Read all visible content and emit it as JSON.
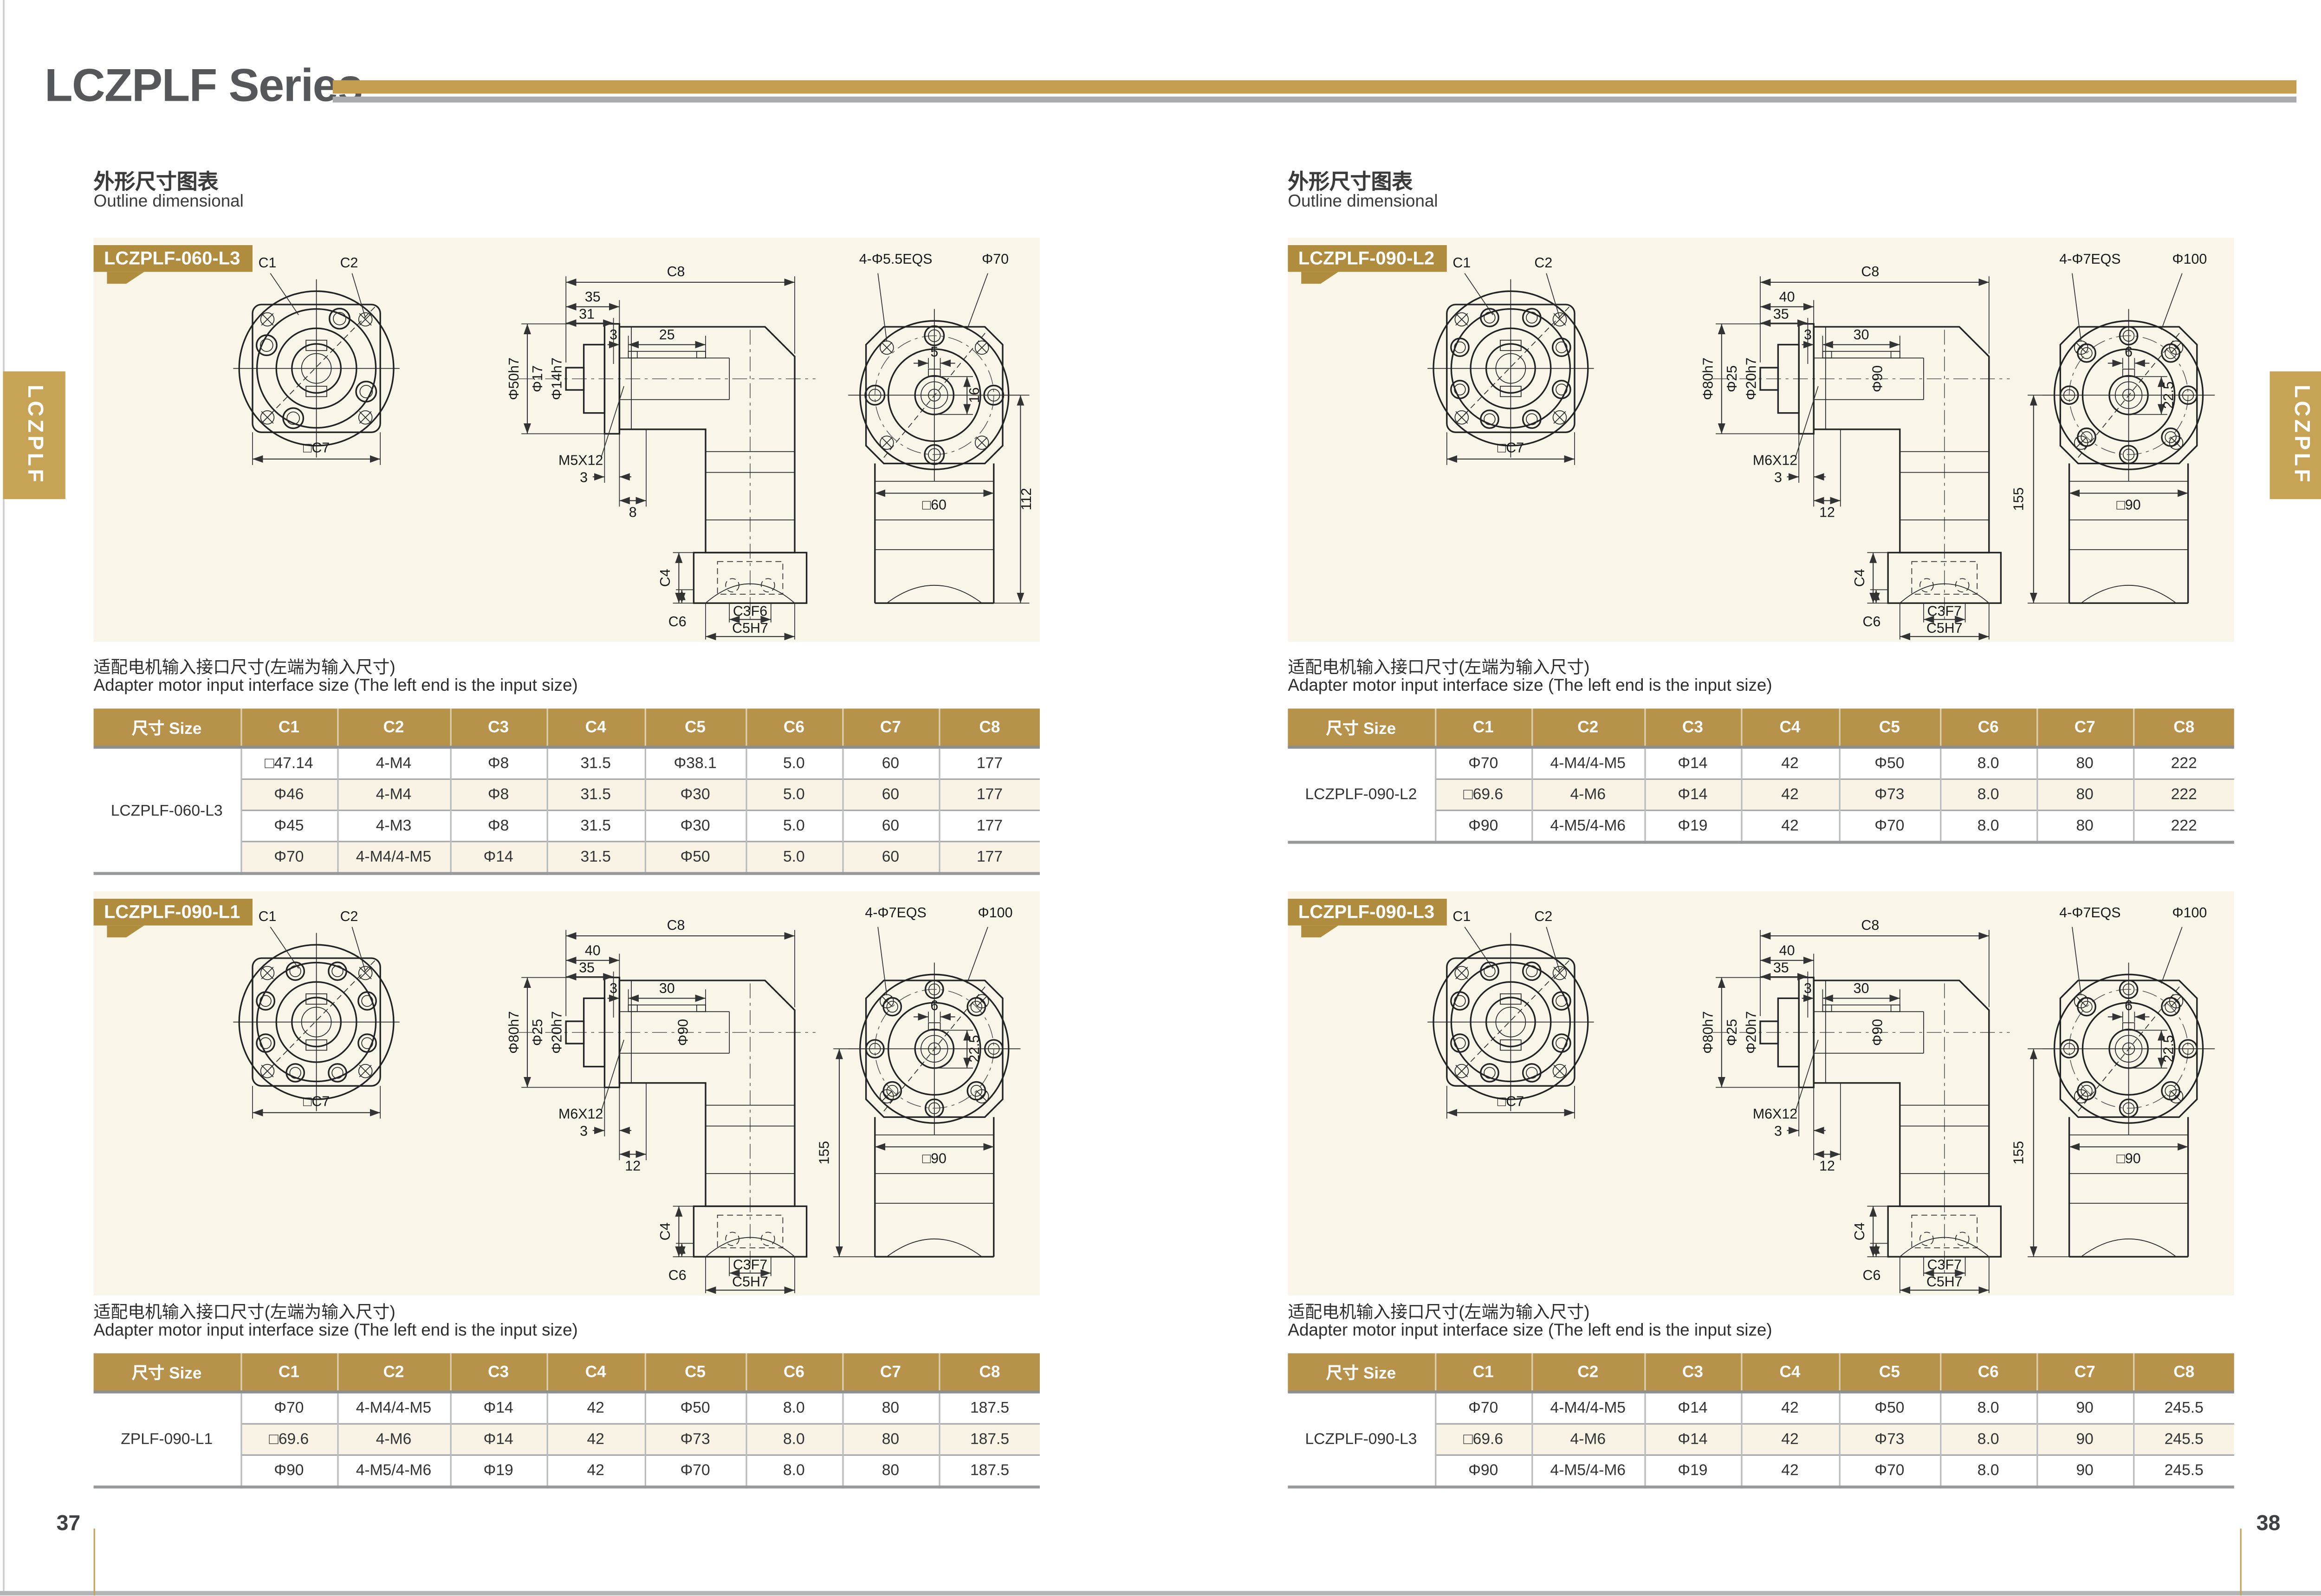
{
  "page": {
    "title": "LCZPLF Series",
    "side_tab": "LCZPLF",
    "page_no_left": "37",
    "page_no_right": "38"
  },
  "colors": {
    "accent_gold": "#c49d4f",
    "badge_gold": "#af8c3e",
    "table_header_gold": "#b6924a",
    "panel_cream": "#f9f5e8",
    "title_gray": "#56575b"
  },
  "section_heading": {
    "zh": "外形尺寸图表",
    "en": "Outline dimensional"
  },
  "note": {
    "zh": "适配电机输入接口尺寸(左端为输入尺寸)",
    "en": "Adapter motor input interface size (The left end is the input size)"
  },
  "columns": [
    "尺寸 Size",
    "C1",
    "C2",
    "C3",
    "C4",
    "C5",
    "C6",
    "C7",
    "C8"
  ],
  "panels": [
    {
      "badge": "LCZPLF-060-L3",
      "row_label": "LCZPLF-060-L3",
      "labels": {
        "c1": "C1",
        "c2": "C2",
        "c7": "□C7",
        "c8": "C8",
        "dimA": "35",
        "dimB": "31",
        "dimC": "3",
        "dimD": "25",
        "shaft1": "Φ50h7",
        "shaft2": "Φ17",
        "shaft3": "Φ14h7",
        "thread": "M5X12",
        "botA": "3",
        "botB": "8",
        "bolts": "4-Φ5.5EQS",
        "flange": "Φ70",
        "key": "5",
        "depth": "16",
        "square": "□60",
        "height": "112",
        "c4": "C4",
        "c6": "C6",
        "c3": "C3F6",
        "c5": "C5H7"
      },
      "rows": [
        [
          "□47.14",
          "4-M4",
          "Φ8",
          "31.5",
          "Φ38.1",
          "5.0",
          "60",
          "177"
        ],
        [
          "Φ46",
          "4-M4",
          "Φ8",
          "31.5",
          "Φ30",
          "5.0",
          "60",
          "177"
        ],
        [
          "Φ45",
          "4-M3",
          "Φ8",
          "31.5",
          "Φ30",
          "5.0",
          "60",
          "177"
        ],
        [
          "Φ70",
          "4-M4/4-M5",
          "Φ14",
          "31.5",
          "Φ50",
          "5.0",
          "60",
          "177"
        ]
      ]
    },
    {
      "badge": "LCZPLF-090-L2",
      "row_label": "LCZPLF-090-L2",
      "labels": {
        "c1": "C1",
        "c2": "C2",
        "c7": "□C7",
        "c8": "C8",
        "dimA": "40",
        "dimB": "35",
        "dimC": "3",
        "dimD": "30",
        "shaft1": "Φ80h7",
        "shaft2": "Φ25",
        "shaft3": "Φ20h7",
        "thread": "M6X12",
        "botA": "3",
        "botB": "12",
        "body": "Φ90",
        "bolts": "4-Φ7EQS",
        "flange": "Φ100",
        "key": "6",
        "depth": "22.5",
        "square": "□90",
        "height": "155",
        "c4": "C4",
        "c6": "C6",
        "c3": "C3F7",
        "c5": "C5H7"
      },
      "rows": [
        [
          "Φ70",
          "4-M4/4-M5",
          "Φ14",
          "42",
          "Φ50",
          "8.0",
          "80",
          "222"
        ],
        [
          "□69.6",
          "4-M6",
          "Φ14",
          "42",
          "Φ73",
          "8.0",
          "80",
          "222"
        ],
        [
          "Φ90",
          "4-M5/4-M6",
          "Φ19",
          "42",
          "Φ70",
          "8.0",
          "80",
          "222"
        ]
      ]
    },
    {
      "badge": "LCZPLF-090-L1",
      "row_label": "ZPLF-090-L1",
      "labels": {
        "c1": "C1",
        "c2": "C2",
        "c7": "□C7",
        "c8": "C8",
        "dimA": "40",
        "dimB": "35",
        "dimC": "3",
        "dimD": "30",
        "shaft1": "Φ80h7",
        "shaft2": "Φ25",
        "shaft3": "Φ20h7",
        "thread": "M6X12",
        "botA": "3",
        "botB": "12",
        "body": "Φ90",
        "bolts": "4-Φ7EQS",
        "flange": "Φ100",
        "key": "6",
        "depth": "22.5",
        "square": "□90",
        "height": "155",
        "c4": "C4",
        "c6": "C6",
        "c3": "C3F7",
        "c5": "C5H7"
      },
      "rows": [
        [
          "Φ70",
          "4-M4/4-M5",
          "Φ14",
          "42",
          "Φ50",
          "8.0",
          "80",
          "187.5"
        ],
        [
          "□69.6",
          "4-M6",
          "Φ14",
          "42",
          "Φ73",
          "8.0",
          "80",
          "187.5"
        ],
        [
          "Φ90",
          "4-M5/4-M6",
          "Φ19",
          "42",
          "Φ70",
          "8.0",
          "80",
          "187.5"
        ]
      ]
    },
    {
      "badge": "LCZPLF-090-L3",
      "row_label": "LCZPLF-090-L3",
      "labels": {
        "c1": "C1",
        "c2": "C2",
        "c7": "□C7",
        "c8": "C8",
        "dimA": "40",
        "dimB": "35",
        "dimC": "3",
        "dimD": "30",
        "shaft1": "Φ80h7",
        "shaft2": "Φ25",
        "shaft3": "Φ20h7",
        "thread": "M6X12",
        "botA": "3",
        "botB": "12",
        "body": "Φ90",
        "bolts": "4-Φ7EQS",
        "flange": "Φ100",
        "key": "6",
        "depth": "22.5",
        "square": "□90",
        "height": "155",
        "c4": "C4",
        "c6": "C6",
        "c3": "C3F7",
        "c5": "C5H7"
      },
      "rows": [
        [
          "Φ70",
          "4-M4/4-M5",
          "Φ14",
          "42",
          "Φ50",
          "8.0",
          "90",
          "245.5"
        ],
        [
          "□69.6",
          "4-M6",
          "Φ14",
          "42",
          "Φ73",
          "8.0",
          "90",
          "245.5"
        ],
        [
          "Φ90",
          "4-M5/4-M6",
          "Φ19",
          "42",
          "Φ70",
          "8.0",
          "90",
          "245.5"
        ]
      ]
    }
  ]
}
